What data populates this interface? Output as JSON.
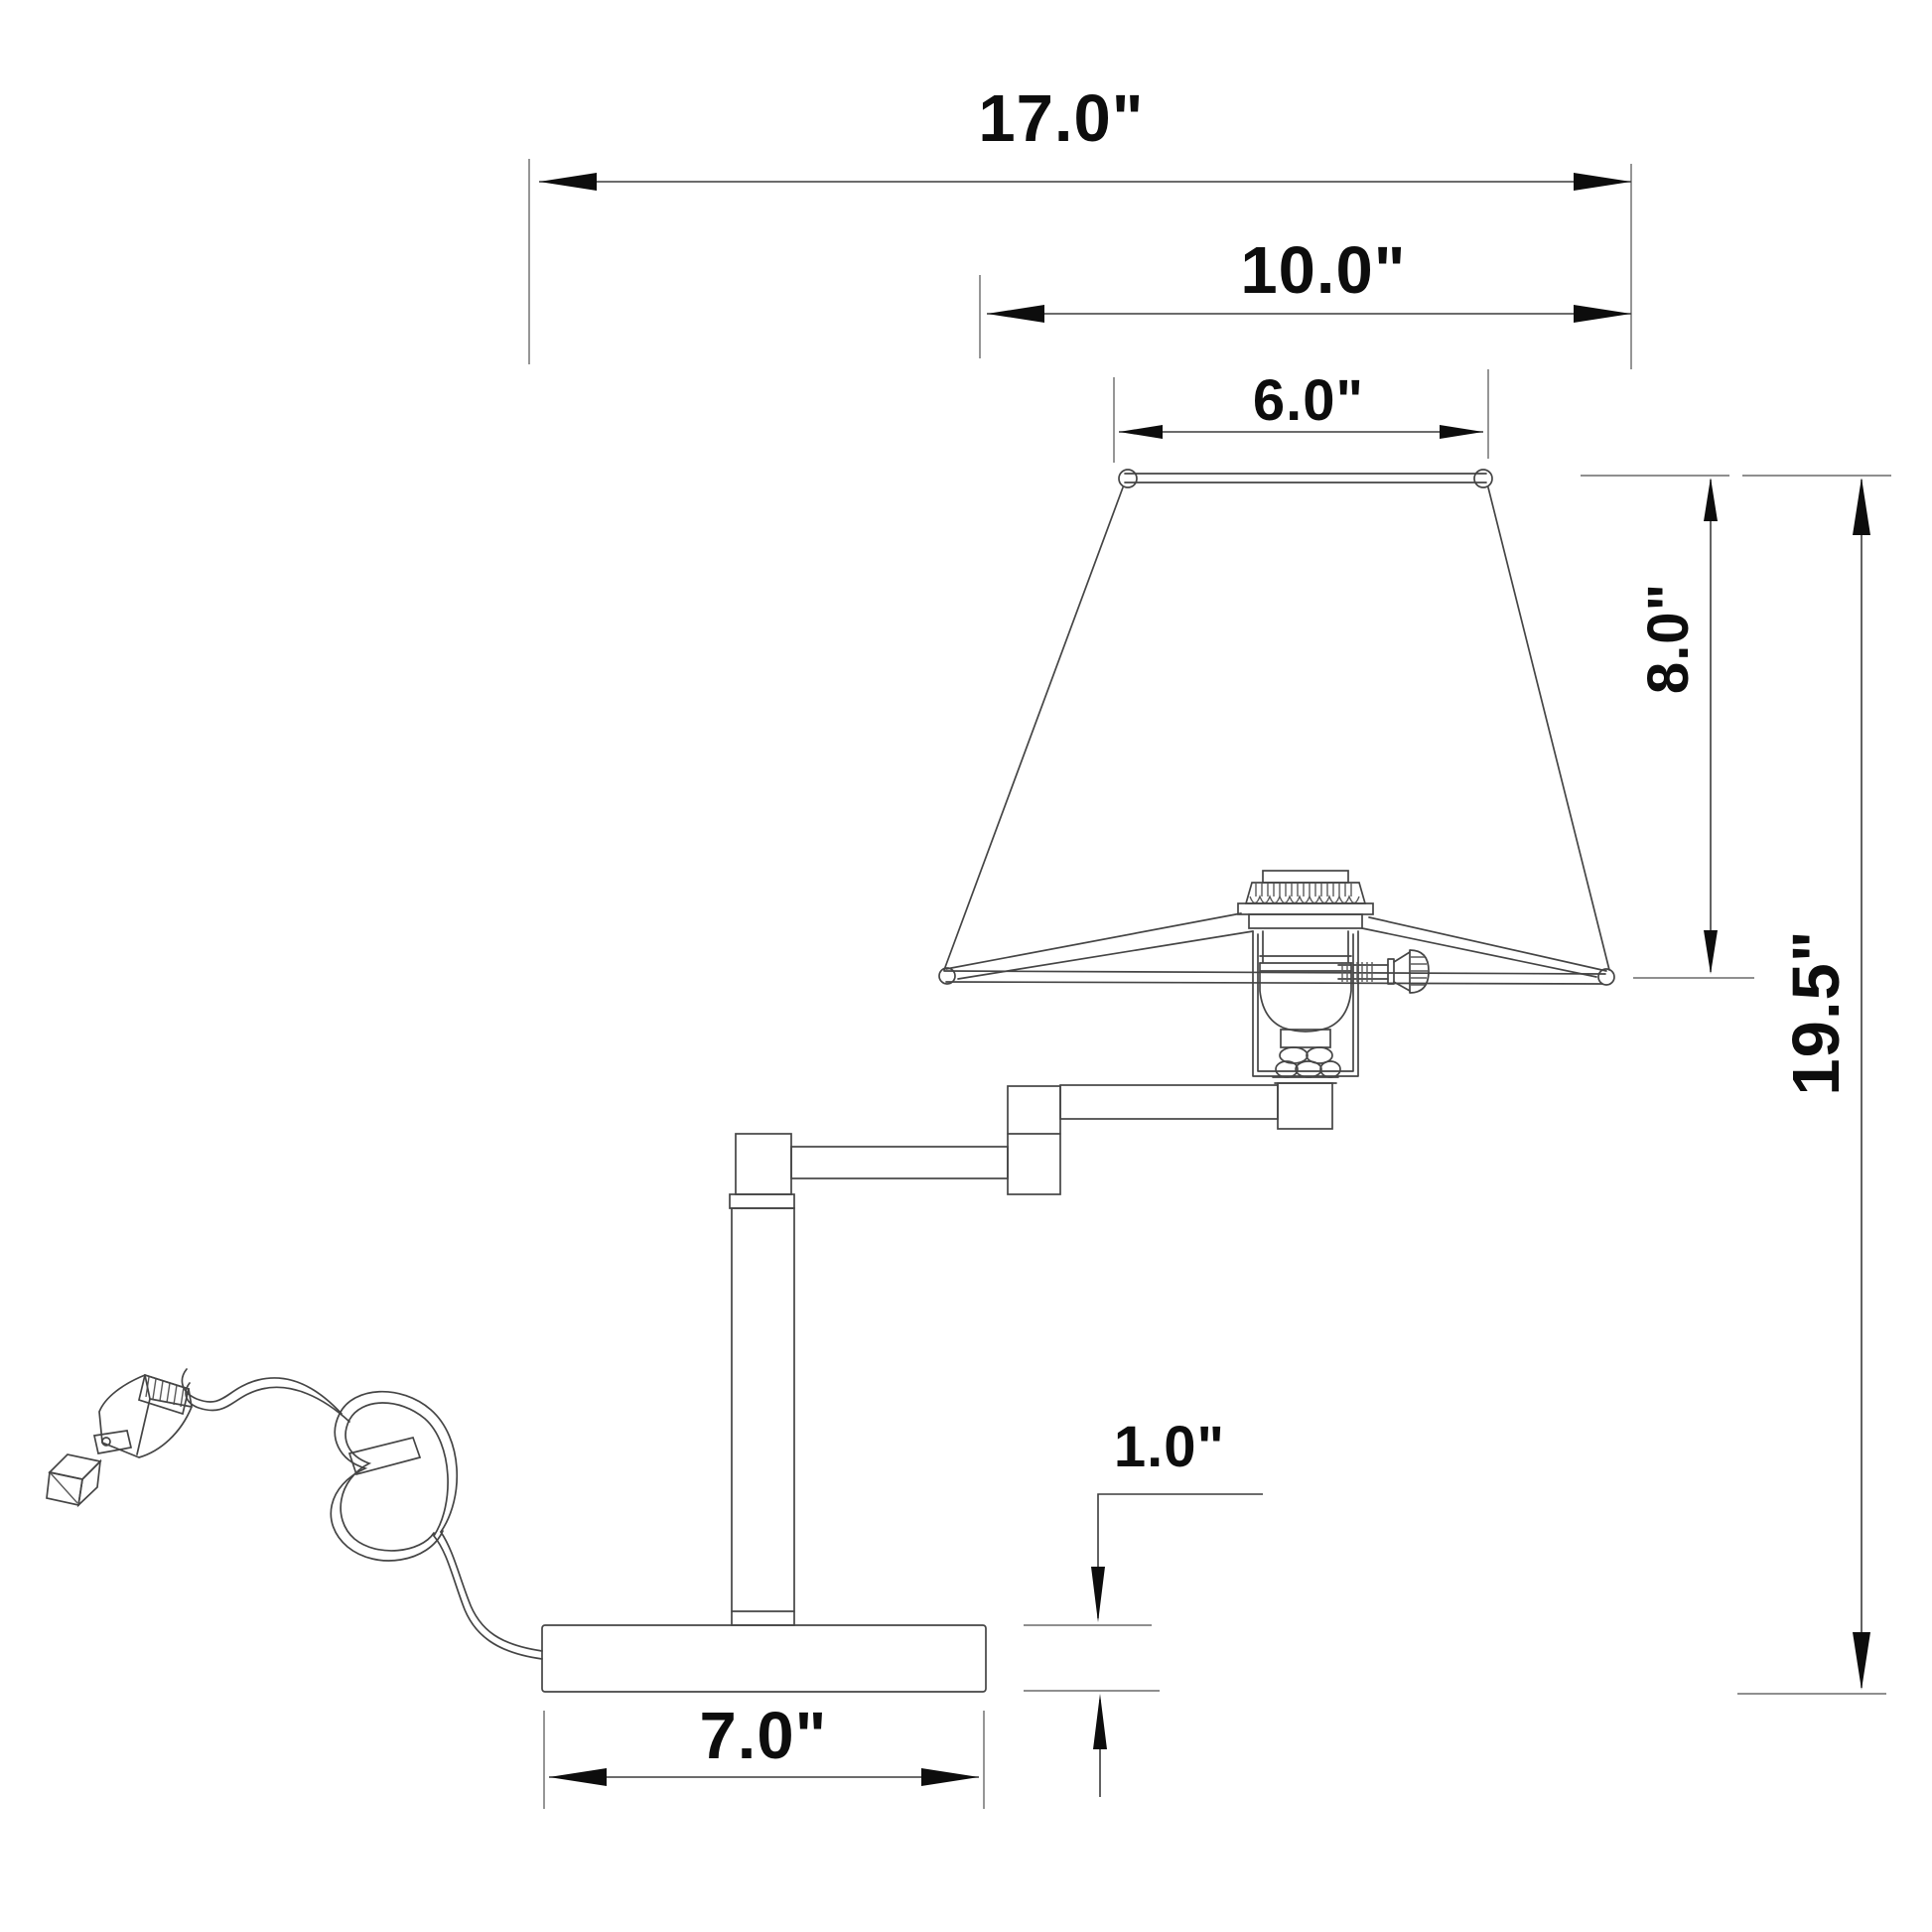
{
  "drawing": {
    "title": "swing-arm table lamp dimension drawing",
    "background_color": "#ffffff",
    "line_color": "#454545",
    "annotation_color": "#0d0d0d"
  },
  "labels": {
    "shade_span": "17.0\"",
    "shade_bottom": "10.0\"",
    "shade_top": "6.0\"",
    "shade_height": "8.0\"",
    "overall_height": "19.5\"",
    "base_thickness": "1.0\"",
    "base_width": "7.0\""
  }
}
